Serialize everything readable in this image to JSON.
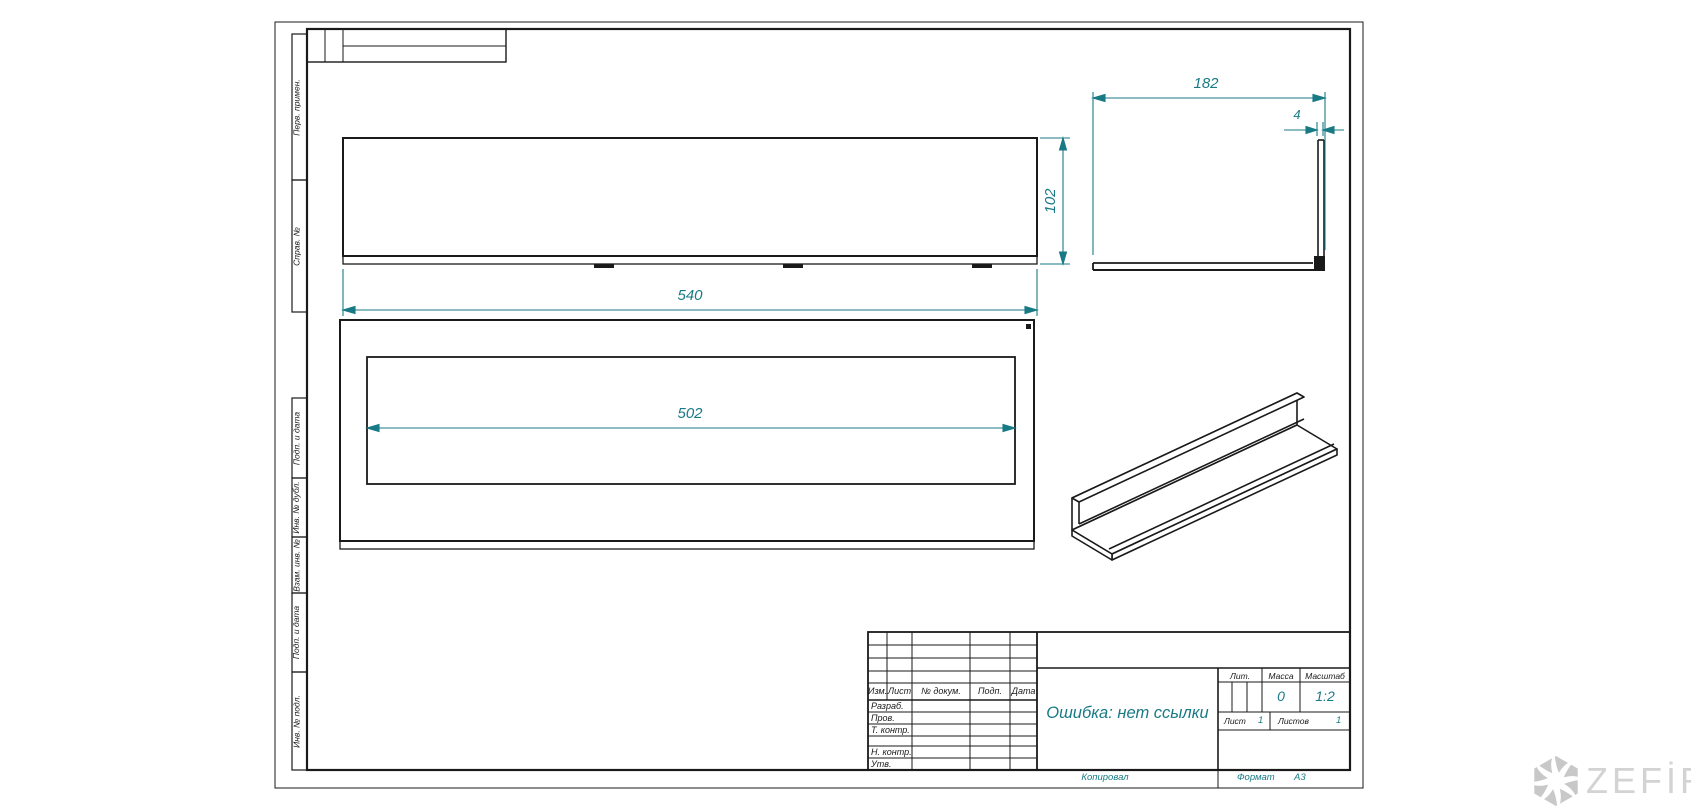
{
  "margin_labels": [
    "Перв. примен.",
    "Справ. №",
    "Подп. и дата",
    "Инв. № дубл.",
    "Взам. инв. №",
    "Подп. и дата",
    "Инв. № подл."
  ],
  "dimensions": {
    "front_width": "540",
    "opening_width": "502",
    "front_height": "102",
    "side_depth": "182",
    "wall_thickness": "4"
  },
  "title_block": {
    "headers": [
      "Изм.",
      "Лист",
      "№ докум.",
      "Подп.",
      "Дата"
    ],
    "roles": [
      "Разраб.",
      "Пров.",
      "Т. контр.",
      "Н. контр.",
      "Утв."
    ],
    "title": "Ошибка: нет ссылки",
    "lit_label": "Лит.",
    "mass_label": "Масса",
    "scale_label": "Масштаб",
    "mass_value": "0",
    "scale_value": "1:2",
    "sheet_label": "Лист",
    "sheet_value": "1",
    "sheets_label": "Листов",
    "sheets_value": "1"
  },
  "footer": {
    "copied_by": "Копировал",
    "format_label": "Формат",
    "format_value": "А3"
  },
  "watermark": {
    "brand": "ZEFİRE"
  },
  "colors": {
    "dimension": "#187a85",
    "line": "#1a1a1a",
    "watermark": "#d3d3d3"
  }
}
